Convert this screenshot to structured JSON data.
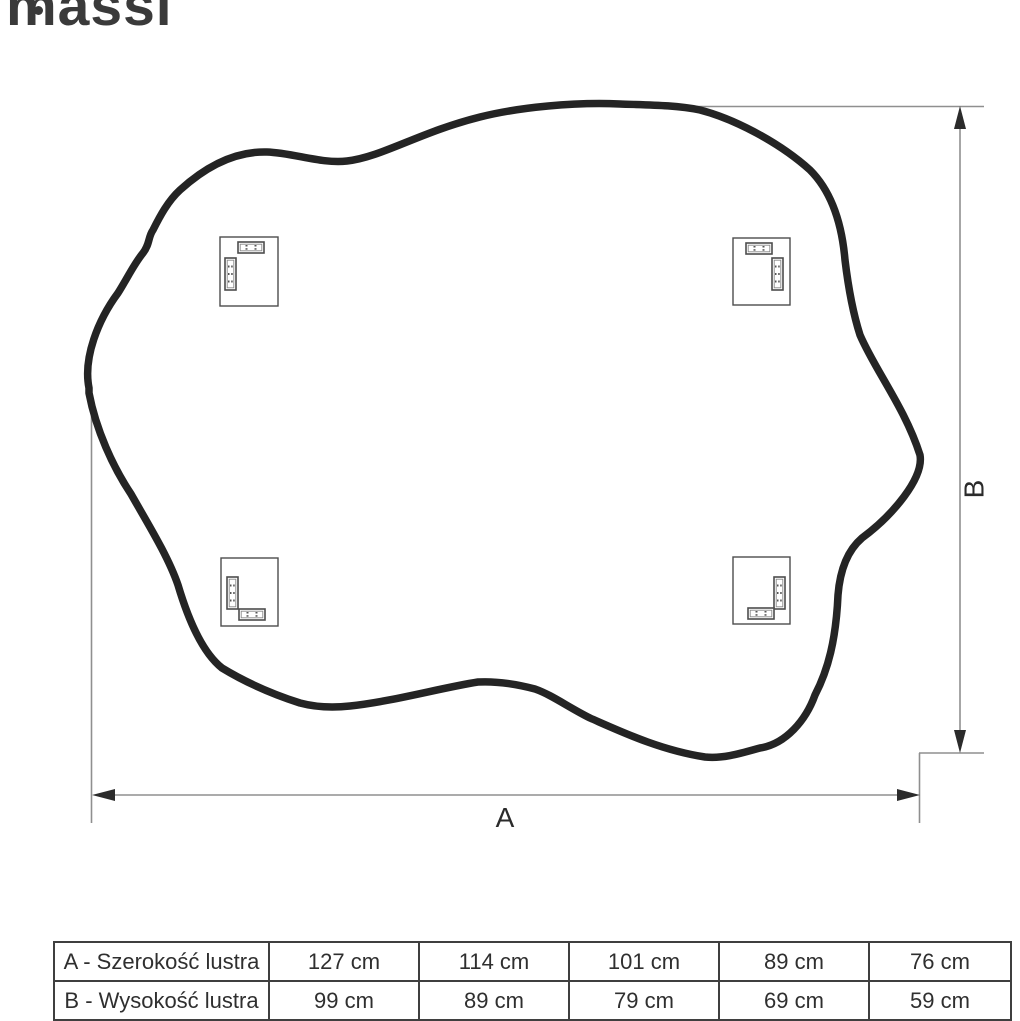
{
  "brand": {
    "logo_text": "massi"
  },
  "diagram": {
    "width_label": "A",
    "height_label": "B",
    "shape": "irregular-organic-mirror-outline",
    "brackets_count": 4,
    "colors": {
      "outline": "#242424",
      "dimension_line": "#8f8f8f",
      "arrowhead": "#2b2b2b",
      "label_text": "#2b2b2b",
      "logo": "#3a3a3a",
      "table_border": "#3f3f3f",
      "table_text": "#2f2f2f"
    },
    "icons": {
      "arrow_up": "▲",
      "arrow_down": "▼",
      "arrow_left": "◀",
      "arrow_right": "▶"
    }
  },
  "table": {
    "rows": [
      {
        "label": "A - Szerokość lustra",
        "values": [
          "127 cm",
          "114 cm",
          "101 cm",
          "89 cm",
          "76 cm"
        ]
      },
      {
        "label": "B - Wysokość lustra",
        "values": [
          "99 cm",
          "89 cm",
          "79 cm",
          "69 cm",
          "59 cm"
        ]
      }
    ]
  }
}
